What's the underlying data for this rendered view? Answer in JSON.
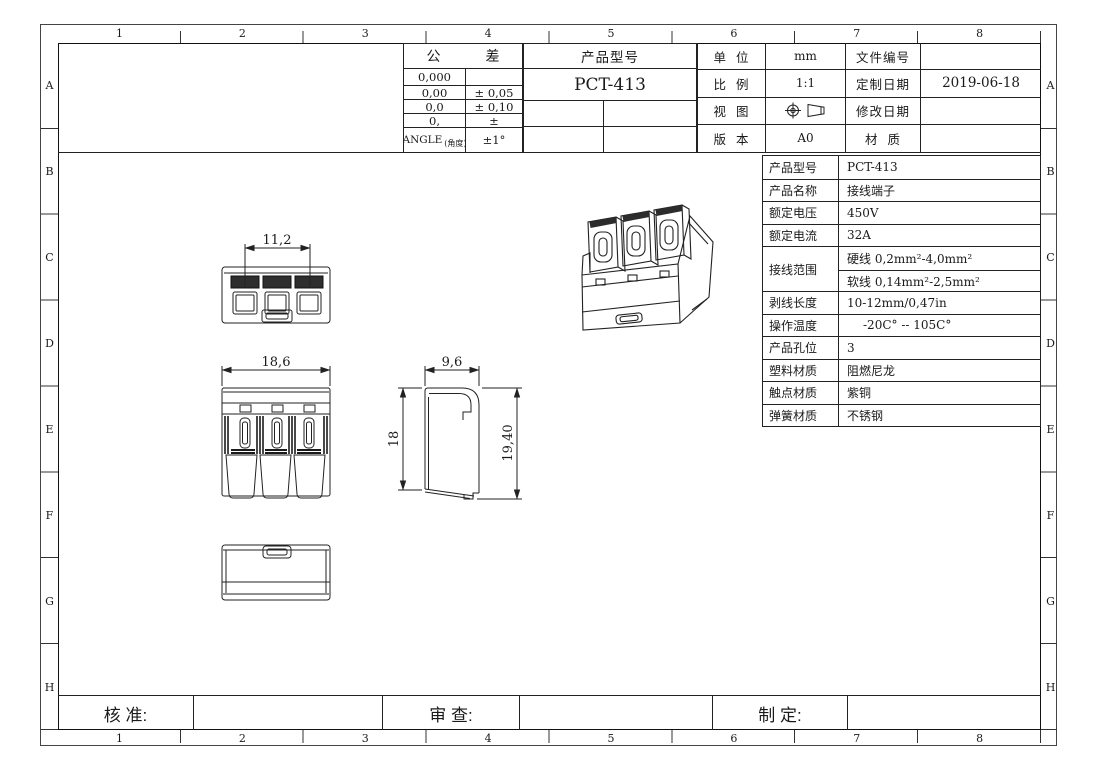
{
  "frame": {
    "columns": [
      "1",
      "2",
      "3",
      "4",
      "5",
      "6",
      "7",
      "8"
    ],
    "rows": [
      "A",
      "B",
      "C",
      "D",
      "E",
      "F",
      "G",
      "H"
    ]
  },
  "tolerance_block": {
    "title_left": "公",
    "title_right": "差",
    "rows": [
      {
        "digits": "0,000",
        "tolerance": ""
      },
      {
        "digits": "0,00",
        "tolerance": "± 0,05"
      },
      {
        "digits": "0,0",
        "tolerance": "± 0,10"
      },
      {
        "digits": "0,",
        "tolerance": "±"
      },
      {
        "digits": "ANGLE",
        "digits_note": "(角度)",
        "tolerance": "±1°"
      }
    ]
  },
  "product_block": {
    "title": "产品型号",
    "model": "PCT-413"
  },
  "info_block": {
    "unit_label": "单  位",
    "unit_value": "mm",
    "file_no_label": "文件编号",
    "file_no_value": "",
    "scale_label": "比  例",
    "scale_value": "1:1",
    "custom_date_label": "定制日期",
    "custom_date_value": "2019-06-18",
    "view_label": "视  图",
    "modify_date_label": "修改日期",
    "modify_date_value": "",
    "version_label": "版  本",
    "version_value": "A0",
    "material_label": "材  质",
    "material_value": ""
  },
  "spec_table": {
    "rows": [
      {
        "label": "产品型号",
        "value": "PCT-413"
      },
      {
        "label": "产品名称",
        "value": "接线端子"
      },
      {
        "label": "额定电压",
        "value": "450V"
      },
      {
        "label": "额定电流",
        "value": "32A"
      },
      {
        "label": "接线范围",
        "value_hard": "硬线 0,2mm²-4,0mm²",
        "value_soft": "软线 0,14mm²-2,5mm²"
      },
      {
        "label": "剥线长度",
        "value": "10-12mm/0,47in"
      },
      {
        "label": "操作温度",
        "value": "-20C° -- 105C°"
      },
      {
        "label": "产品孔位",
        "value": "3"
      },
      {
        "label": "塑料材质",
        "value": "阻燃尼龙"
      },
      {
        "label": "触点材质",
        "value": "紫铜"
      },
      {
        "label": "弹簧材质",
        "value": "不锈钢"
      }
    ]
  },
  "signoff": {
    "approved_label": "核 准:",
    "reviewed_label": "审 查:",
    "prepared_label": "制 定:"
  },
  "views": {
    "top_view": {
      "width_dim": "11,2"
    },
    "front_view": {
      "width_dim": "18,6"
    },
    "side_view": {
      "depth_dim": "9,6",
      "height_left_dim": "18",
      "height_right_dim": "19,40"
    }
  },
  "colors": {
    "line": "#222222",
    "dark_fill": "#2e2e2e"
  }
}
